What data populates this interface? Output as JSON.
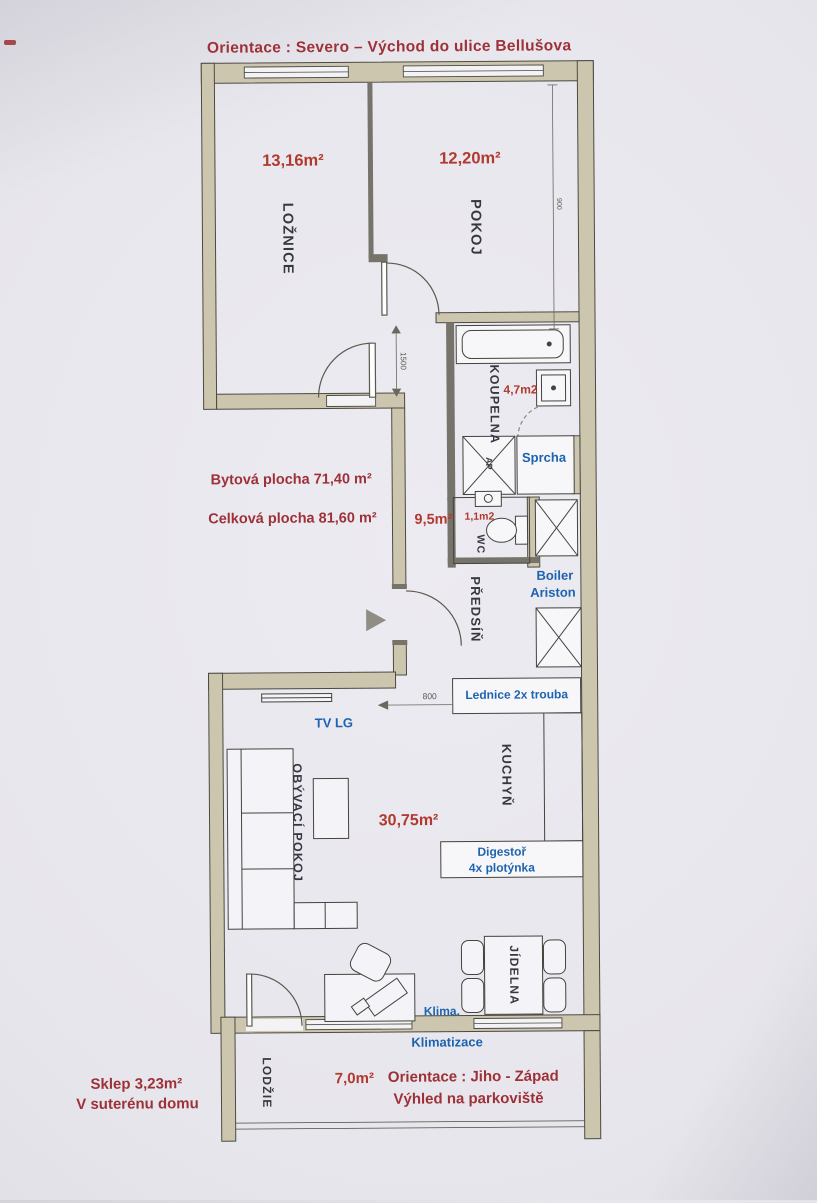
{
  "title": "Orientace : Severo – Východ do ulice Bellušova",
  "summary": {
    "living_area": "Bytová plocha 71,40 m²",
    "total_area": "Celková plocha 81,60 m²",
    "cellar_line1": "Sklep 3,23m²",
    "cellar_line2": "V suterénu domu"
  },
  "rooms": {
    "loznice": {
      "name": "LOŽNICE",
      "area": "13,16m²"
    },
    "pokoj": {
      "name": "POKOJ",
      "area": "12,20m²"
    },
    "koupelna": {
      "name": "KOUPELNA",
      "area": "4,7m2"
    },
    "wc": {
      "name": "WC",
      "area": "1,1m2"
    },
    "predsin": {
      "name": "PŘEDSÍŇ",
      "area": "9,5m²"
    },
    "obyvaci_pokoj": {
      "name": "OBÝVACÍ POKOJ",
      "area": "30,75m²"
    },
    "kuchyn": {
      "name": "KUCHYŇ"
    },
    "jidelna": {
      "name": "JÍDELNA"
    },
    "lodzie": {
      "name": "LODŽIE",
      "area": "7,0m²"
    }
  },
  "equipment": {
    "sprcha": "Sprcha",
    "pracka": "AP",
    "boiler_line1": "Boiler",
    "boiler_line2": "Ariston",
    "lednice": "Lednice 2x trouba",
    "tv": "TV LG",
    "digestor_line1": "Digestoř",
    "digestor_line2": "4x plotýnka",
    "klima": "Klima.",
    "klimatizace": "Klimatizace"
  },
  "loggia_notes": {
    "orientation": "Orientace : Jiho - Západ",
    "view": "Výhled na parkoviště"
  },
  "dimensions": {
    "pokoj_width": "900",
    "door_span": "1500",
    "passage": "800"
  },
  "colors": {
    "red_dark": "#9e3138",
    "red": "#b2392f",
    "blue": "#1e63b0",
    "wall_beige": "#cdc6ae"
  }
}
